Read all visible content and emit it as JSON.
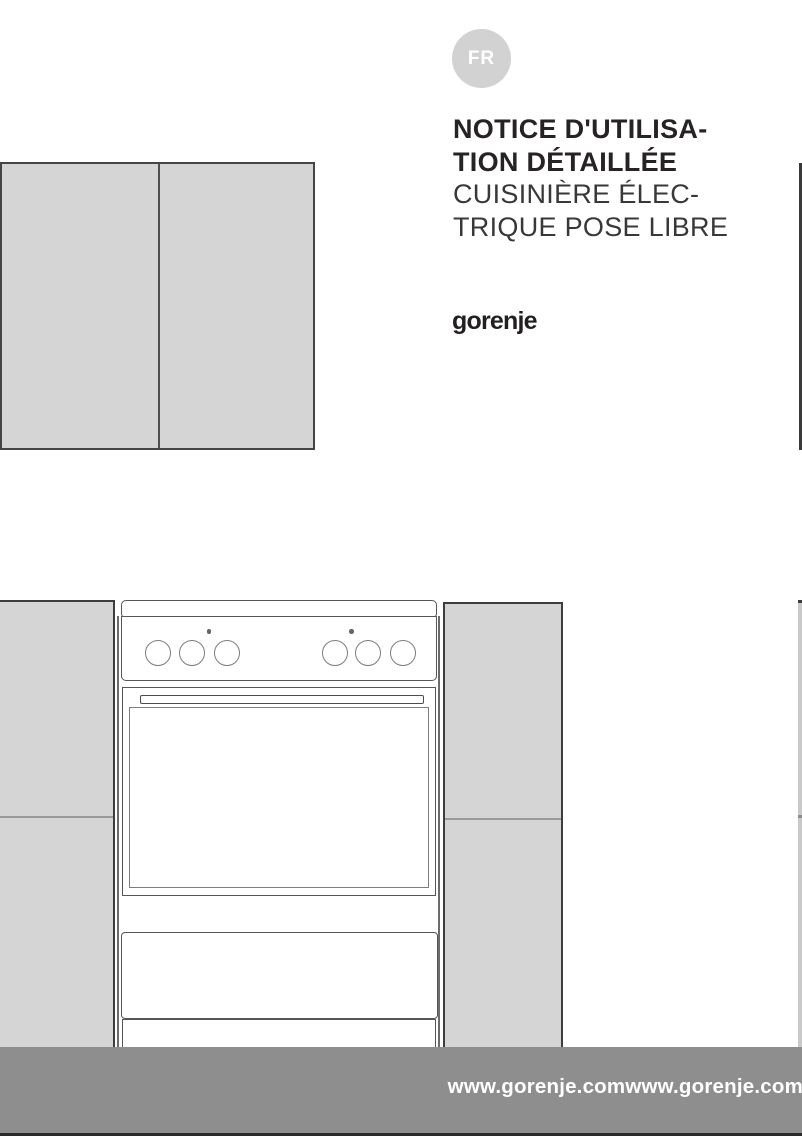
{
  "badge": {
    "label": "FR"
  },
  "title": {
    "bold_line_1": "NOTICE D'UTILISA-",
    "bold_line_2": "TION DÉTAILLÉE",
    "regular_line_1": "CUISINIÈRE ÉLEC-",
    "regular_line_2": "TRIQUE POSE LIBRE"
  },
  "brand": {
    "logo_text": "gorenje"
  },
  "footer": {
    "url_text": "www.gorenje.comwww.gorenje.com"
  },
  "colors": {
    "badge_gray": "#d2d2d2",
    "cabinet_gray": "#d5d5d5",
    "cabinet_border_dark": "#3d3d3d",
    "drawing_line": "#55555a",
    "divider_gray": "#9a9a9a",
    "footer_gray": "#8f8e8f",
    "title_text_dark": "#272223",
    "footer_text_white": "#ffffff"
  },
  "illustration": {
    "appliance": "freestanding-electric-cooker",
    "knob_count": 6,
    "indicator_dot_count": 2
  }
}
